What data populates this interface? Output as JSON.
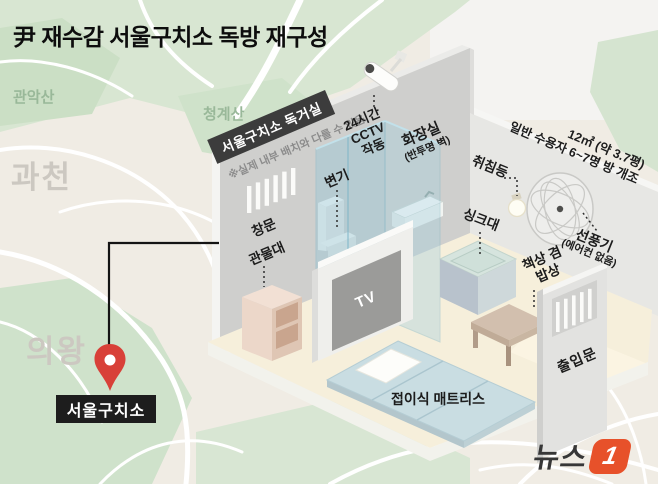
{
  "title": "尹 재수감 서울구치소 독방 재구성",
  "map": {
    "labels": {
      "mountain_nw": "관악산",
      "mountain_ne": "청계산",
      "city_west": "과천",
      "city_south": "의왕"
    },
    "pin_label": "서울구치소"
  },
  "room": {
    "banner": "서울구치소 독거실",
    "disclaimer": "※실제 내부 배치와 다를 수 있음",
    "area_line1": "12㎡ (약 3.7평)",
    "area_line2": "일반 수용자 6~7명 방 개조",
    "labels": {
      "cctv": "24시간\nCCTV\n작동",
      "bathroom": "화장실",
      "bathroom_sub": "(반투명 벽)",
      "toilet": "변기",
      "window": "창문",
      "locker": "관물대",
      "tv": "TV",
      "sink": "싱크대",
      "sleep_light": "취침등",
      "fan": "선풍기",
      "fan_sub": "(에어컨 없음)",
      "desk": "책상 겸\n밥상",
      "door": "출입문",
      "mattress": "접이식 매트리스"
    }
  },
  "logo": {
    "text": "뉴스",
    "badge": "1"
  },
  "colors": {
    "pin_red": "#d84038",
    "logo_red": "#e7512a",
    "banner_bg": "#3c3c3c",
    "map_green": "#d8e6d2",
    "glass_blue": "#9ac8d8",
    "mattress_blue": "#c9dde2"
  }
}
